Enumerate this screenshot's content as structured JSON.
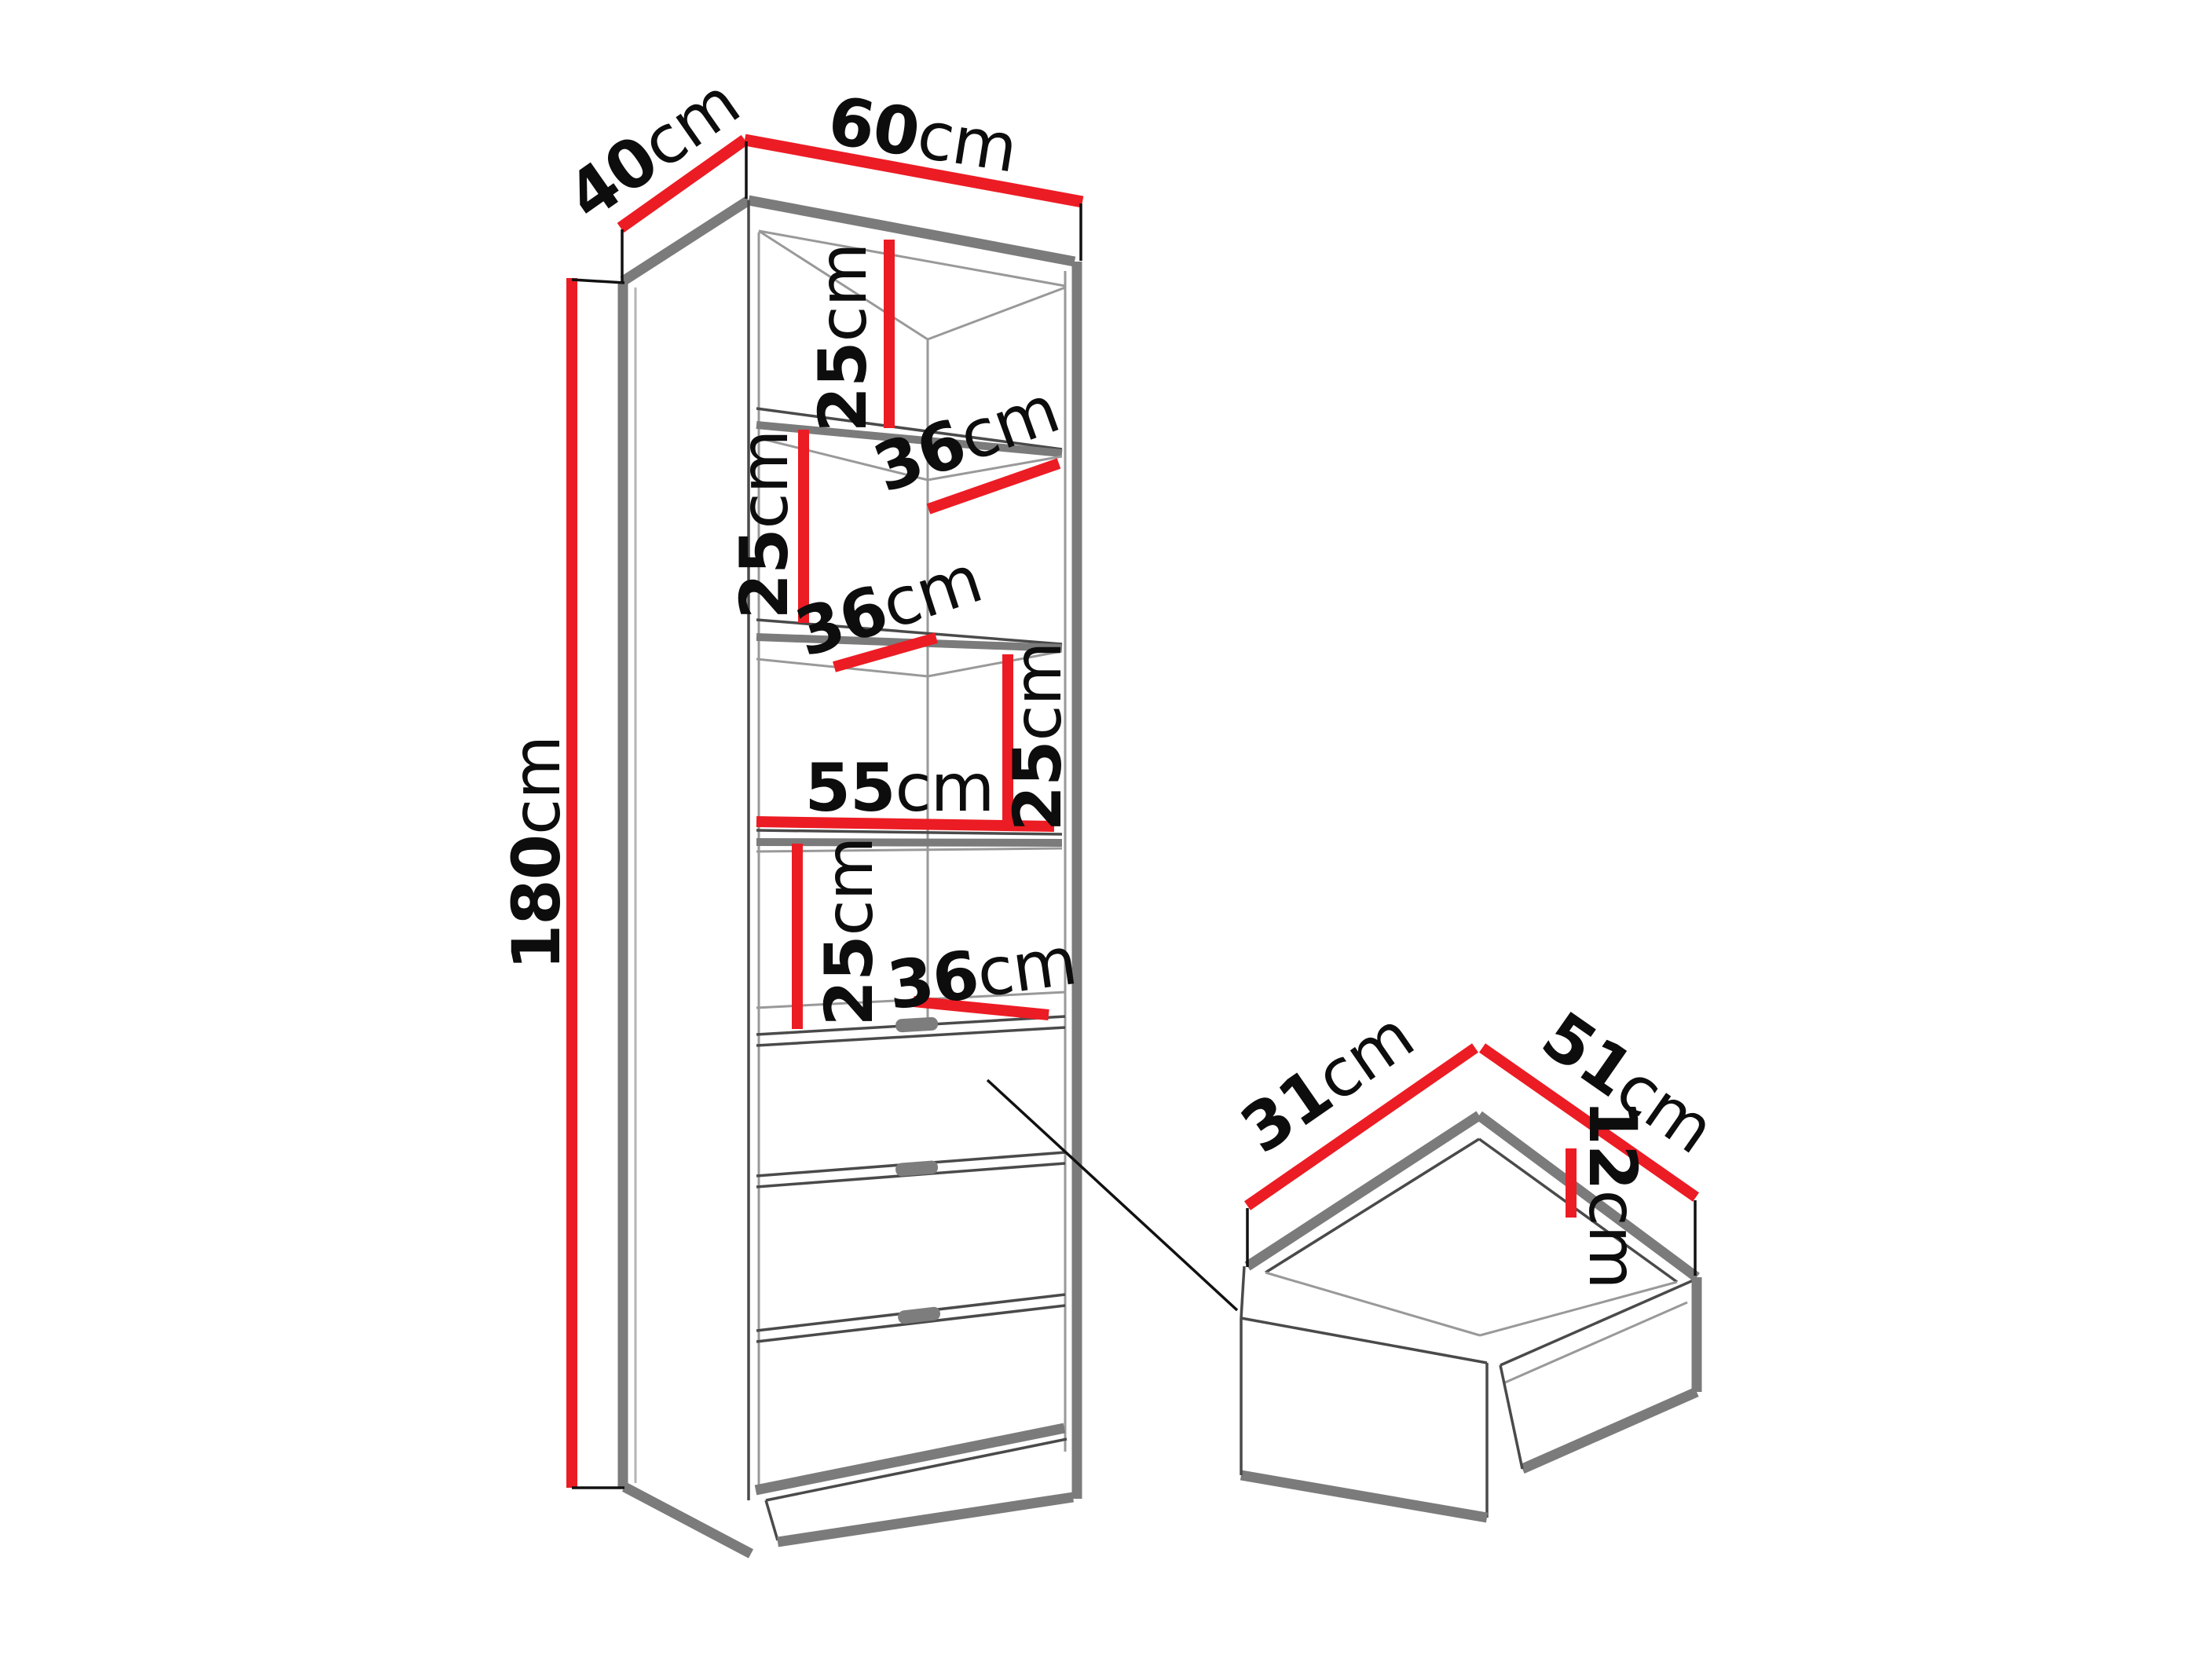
{
  "diagram": {
    "unit": "cm",
    "cabinet": {
      "width_top": {
        "value": "60",
        "unit": "cm"
      },
      "depth_top": {
        "value": "40",
        "unit": "cm"
      },
      "height": {
        "value": "180",
        "unit": "cm"
      },
      "inner_width": {
        "value": "55",
        "unit": "cm"
      },
      "section_heights": [
        {
          "value": "25",
          "unit": "cm"
        },
        {
          "value": "25",
          "unit": "cm"
        },
        {
          "value": "25",
          "unit": "cm"
        },
        {
          "value": "25",
          "unit": "cm"
        }
      ],
      "shelf_depths": [
        {
          "value": "36",
          "unit": "cm"
        },
        {
          "value": "36",
          "unit": "cm"
        },
        {
          "value": "36",
          "unit": "cm"
        }
      ],
      "drawer_count": 3
    },
    "drawer_detail": {
      "inner_depth": {
        "value": "31",
        "unit": "cm"
      },
      "inner_width": {
        "value": "51",
        "unit": "cm"
      },
      "inner_height": {
        "value": "12",
        "unit": "cm"
      }
    },
    "colors": {
      "dimension_line": "#ec1c24",
      "edge_gray": "#7b7b7b",
      "line_dark": "#1a1a1a",
      "background": "#ffffff"
    }
  }
}
